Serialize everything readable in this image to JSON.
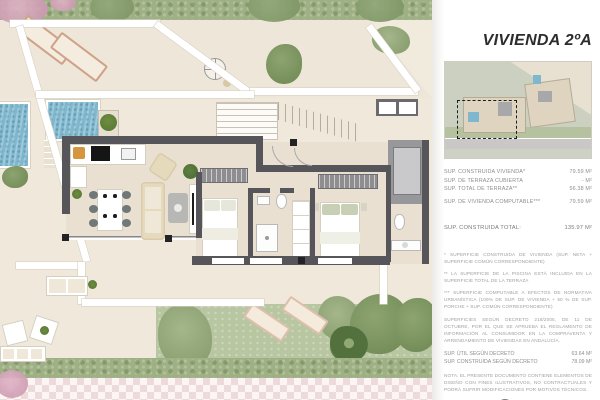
{
  "title": "VIVIENDA 2ºA",
  "panel": {
    "surface_rows": [
      {
        "label": "SUP. CONSTRUIDA VIVIENDA*",
        "value": "79.59 M²"
      },
      {
        "label": "SUP. DE TERRAZA CUBIERTA",
        "value": "- M²"
      },
      {
        "label": "SUP. TOTAL DE TERRAZA**",
        "value": "56.38 M²"
      },
      {
        "label": "SUP. DE VIVIENDA COMPUTABLE***",
        "value": "79.59 M²"
      }
    ],
    "total_row": {
      "label": "SUP. CONSTRUIDA TOTAL:",
      "value": "135.97 M²"
    },
    "footnotes": [
      "* SUPERFICIE CONSTRUIDA DE VIVIENDA (SUP. NETA + SUPERFICIE COMÚN CORRESPONDIENTE)",
      "** LA SUPERFICIE DE LA PISCINA ESTÁ INCLUIDA EN LA SUPERFICIE TOTAL DE LA TERRAZA",
      "*** SUPERFICIE COMPUTABLE A EFECTOS DE NORMATIVA URBANÍSTICA (100% DE SUP. DE VIVIENDA + 50 % DE SUP. PORCHE + SUP. COMÚN CORRESPONDIENTE)"
    ],
    "decree_note": "SUPERFICIES SEGÚN DECRETO 218/2005, DE 11 DE OCTUBRE, POR EL QUE SE APRUEBA EL REGLAMENTO DE INFORMACIÓN AL CONSUMIDOR EN LA COMPRAVENTA Y ARRENDAMIENTO DE VIVIENDAS EN ANDALUCÍA.",
    "decree_rows": [
      {
        "label": "SUP. ÚTIL SEGÚN DECRETO",
        "value": "63.64 M²"
      },
      {
        "label": "SUP. CONSTRUIDA SEGÚN DECRETO",
        "value": "78.09 M²"
      }
    ],
    "nota": "NOTA: EL PRESENTE DOCUMENTO CONTIENE ELEMENTOS DE DISEÑO CON FINES ILUSTRATIVOS, NO CONTRACTUALES Y PODRÁ SUFRIR MODIFICACIONES POR MOTIVOS TÉCNICOS.",
    "footer_label": "COTAS EN METROS"
  },
  "colors": {
    "wall_dark": "#55555a",
    "floor_beige": "#e9e0d1",
    "terrain_beige": "#efe8db",
    "pool_blue": "#7fb8ce",
    "lawn_green": "#b9c6a2",
    "hedge_green": "#9fb087",
    "paving_pink": "#eedada",
    "title_color": "#2d2d2d"
  }
}
